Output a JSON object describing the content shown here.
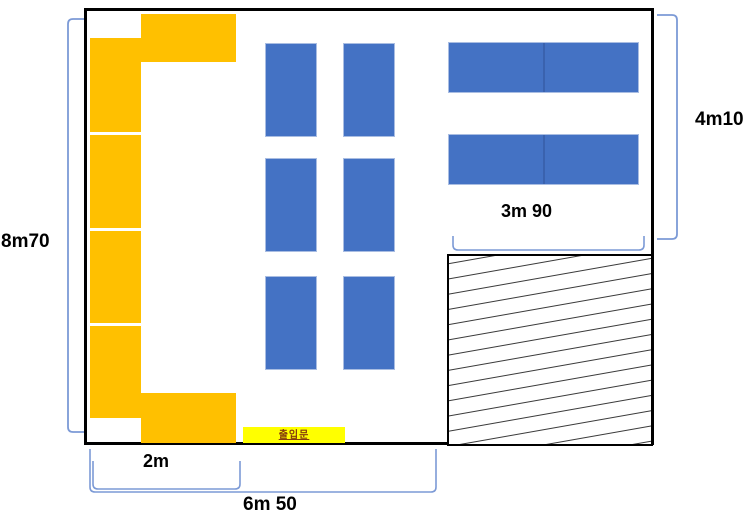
{
  "dimensions": {
    "left_height": "8m70",
    "right_height": "4m10",
    "right_width": "3m 90",
    "left_width": "2m",
    "bottom_width": "6m 50"
  },
  "door": {
    "label": "출입문"
  },
  "colors": {
    "wall": "#000000",
    "furniture_orange": "#FFC000",
    "furniture_blue": "#4472C4",
    "bracket_blue": "#7C9AD6",
    "hatch_line": "#3a3a3a",
    "door_bg": "#FFFF00",
    "door_text": "#843C0C"
  }
}
